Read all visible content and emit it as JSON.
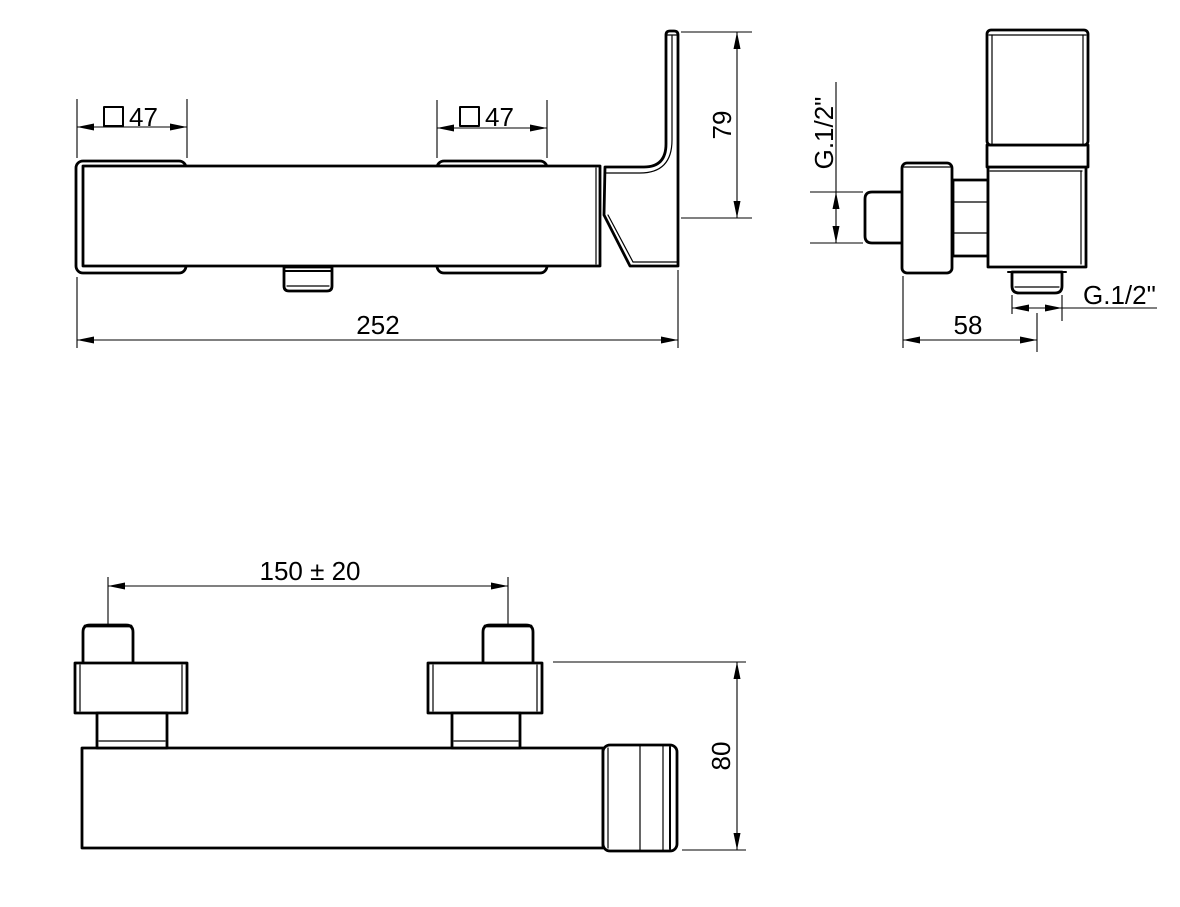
{
  "colors": {
    "line": "#000000",
    "background": "#ffffff"
  },
  "views": {
    "front": {
      "dim_square_left": {
        "symbol": "□",
        "value": "47"
      },
      "dim_square_right": {
        "symbol": "□",
        "value": "47"
      },
      "dim_total_length": "252",
      "dim_handle_height": "79"
    },
    "side": {
      "dim_inlet_thread": "G.1/2\"",
      "dim_depth": "58",
      "dim_outlet_thread": "G.1/2\""
    },
    "plan": {
      "dim_inlet_centres": "150 ± 20",
      "dim_body_depth": "80"
    }
  }
}
